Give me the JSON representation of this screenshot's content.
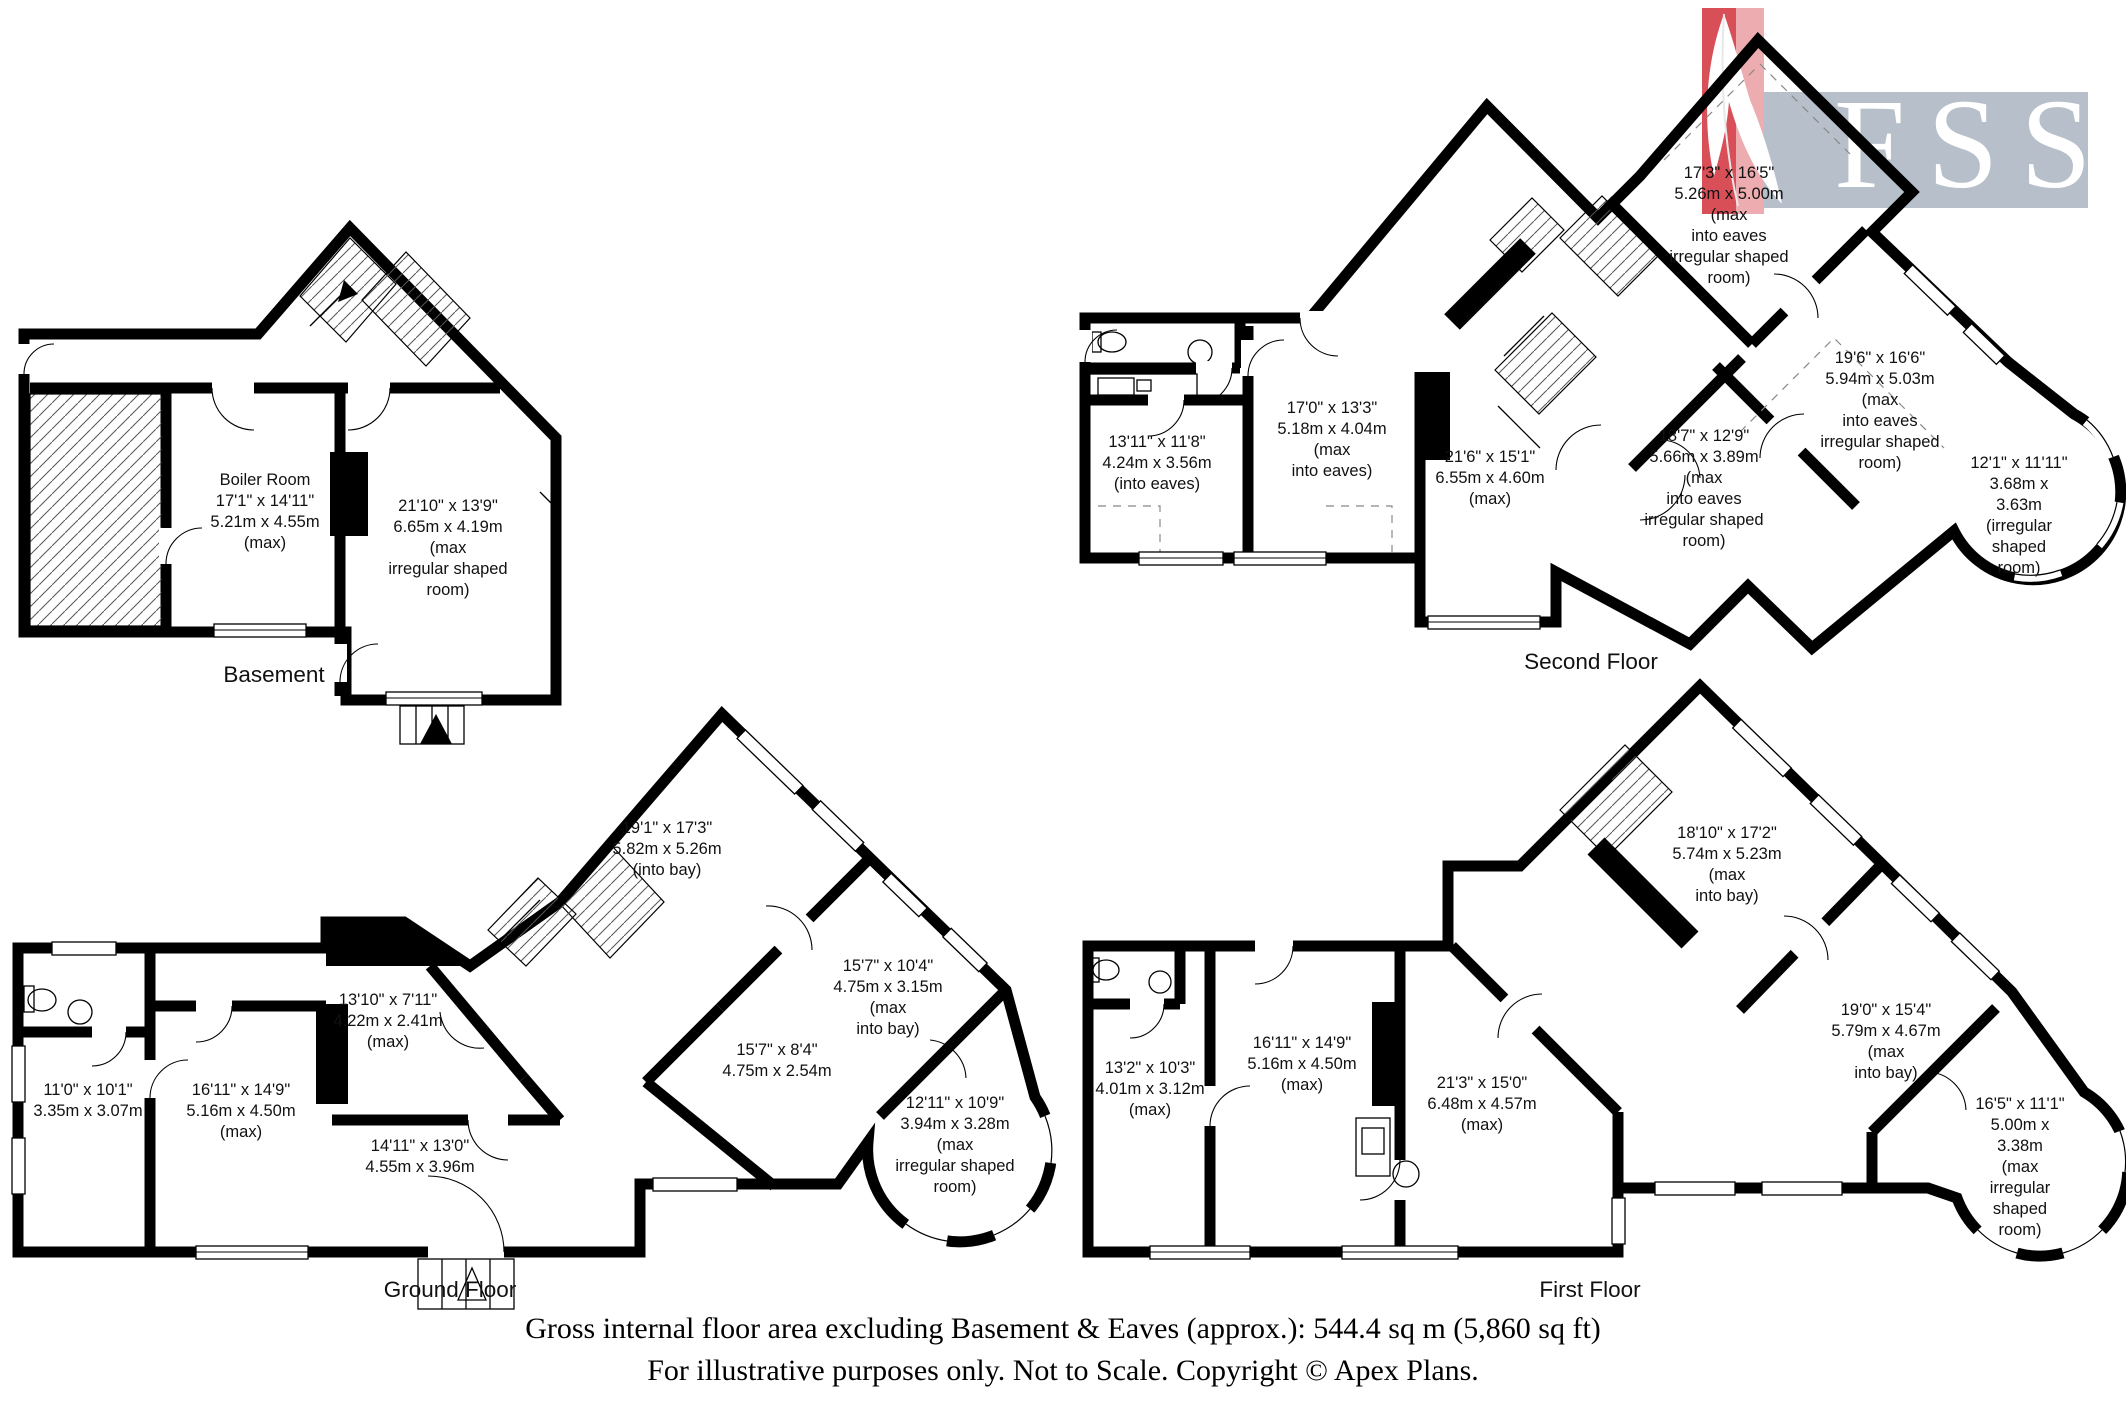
{
  "logo": {
    "text": "FSS"
  },
  "colors": {
    "wall": "#000000",
    "logo_bg": "#b7c0ca",
    "logo_text": "#ffffff",
    "feather_red": "#d94f58",
    "feather_pink": "#ecacb0"
  },
  "floors": [
    {
      "name": "Basement",
      "rooms": [
        {
          "lines": [
            "Boiler Room",
            "17'1\" x 14'11\"",
            "5.21m x 4.55m",
            "(max)"
          ]
        },
        {
          "lines": [
            "21'10\" x 13'9\"",
            "6.65m x 4.19m",
            "(max",
            "irregular shaped",
            "room)"
          ]
        }
      ]
    },
    {
      "name": "Ground Floor",
      "rooms": [
        {
          "lines": [
            "19'1\" x 17'3\"",
            "5.82m x 5.26m",
            "(into bay)"
          ]
        },
        {
          "lines": [
            "13'10\" x 7'11\"",
            "4.22m x 2.41m",
            "(max)"
          ]
        },
        {
          "lines": [
            "11'0\" x 10'1\"",
            "3.35m x 3.07m"
          ]
        },
        {
          "lines": [
            "16'11\" x 14'9\"",
            "5.16m x 4.50m",
            "(max)"
          ]
        },
        {
          "lines": [
            "14'11\" x 13'0\"",
            "4.55m x 3.96m"
          ]
        },
        {
          "lines": [
            "15'7\" x 8'4\"",
            "4.75m x 2.54m"
          ]
        },
        {
          "lines": [
            "15'7\" x 10'4\"",
            "4.75m x 3.15m",
            "(max",
            "into bay)"
          ]
        },
        {
          "lines": [
            "12'11\" x 10'9\"",
            "3.94m x 3.28m",
            "(max",
            "irregular shaped",
            "room)"
          ]
        }
      ]
    },
    {
      "name": "First Floor",
      "rooms": [
        {
          "lines": [
            "13'2\" x 10'3\"",
            "4.01m x 3.12m",
            "(max)"
          ]
        },
        {
          "lines": [
            "16'11\" x 14'9\"",
            "5.16m x 4.50m",
            "(max)"
          ]
        },
        {
          "lines": [
            "21'3\" x 15'0\"",
            "6.48m x 4.57m",
            "(max)"
          ]
        },
        {
          "lines": [
            "18'10\" x 17'2\"",
            "5.74m x 5.23m",
            "(max",
            "into bay)"
          ]
        },
        {
          "lines": [
            "19'0\" x 15'4\"",
            "5.79m x 4.67m",
            "(max",
            "into bay)"
          ]
        },
        {
          "lines": [
            "16'5\" x 11'1\"",
            "5.00m x 3.38m",
            "(max",
            "irregular shaped",
            "room)"
          ]
        }
      ]
    },
    {
      "name": "Second Floor",
      "rooms": [
        {
          "lines": [
            "17'3\" x 16'5\"",
            "5.26m x 5.00m",
            "(max",
            "into eaves",
            "irregular shaped",
            "room)"
          ]
        },
        {
          "lines": [
            "13'11\" x 11'8\"",
            "4.24m x 3.56m",
            "(into eaves)"
          ]
        },
        {
          "lines": [
            "17'0\" x 13'3\"",
            "5.18m x 4.04m",
            "(max",
            "into eaves)"
          ]
        },
        {
          "lines": [
            "21'6\" x 15'1\"",
            "6.55m x 4.60m",
            "(max)"
          ]
        },
        {
          "lines": [
            "18'7\" x 12'9\"",
            "5.66m x 3.89m",
            "(max",
            "into eaves",
            "irregular shaped",
            "room)"
          ]
        },
        {
          "lines": [
            "19'6\" x 16'6\"",
            "5.94m x 5.03m",
            "(max",
            "into eaves",
            "irregular shaped",
            "room)"
          ]
        },
        {
          "lines": [
            "12'1\" x 11'11\"",
            "3.68m x 3.63m",
            "(irregular shaped",
            "room)"
          ]
        }
      ]
    }
  ],
  "caption": {
    "line1": "Gross internal floor area excluding Basement & Eaves (approx.): 544.4 sq m (5,860 sq ft)",
    "line2": "For illustrative purposes only. Not to Scale. Copyright © Apex Plans."
  }
}
